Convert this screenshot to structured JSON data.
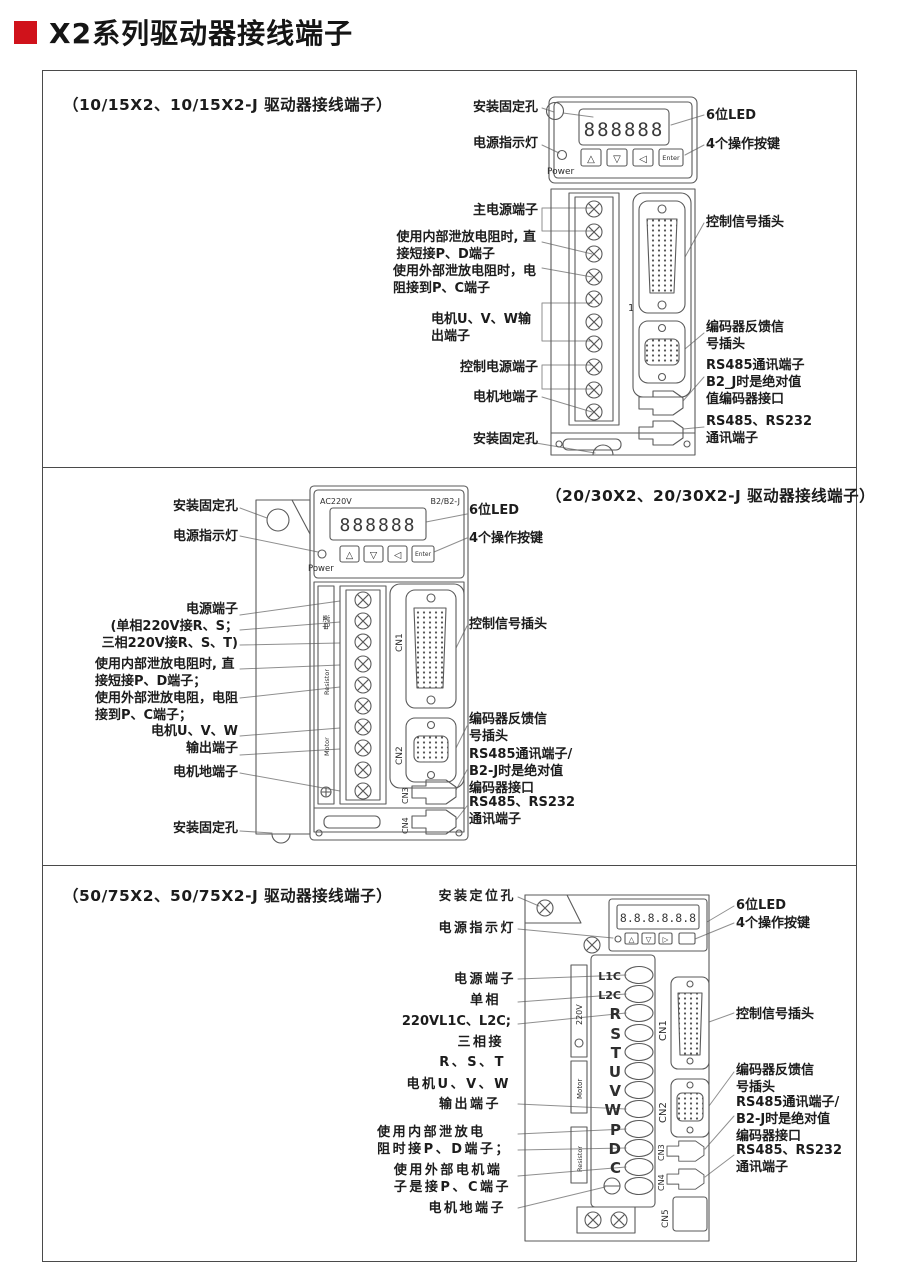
{
  "page_title": "X2系列驱动器接线端子",
  "colors": {
    "accent": "#d0121b",
    "line": "#5a5a5a",
    "text": "#1c1c1c"
  },
  "panels": [
    {
      "title": "（10/15X2、10/15X2-J 驱动器接线端子）",
      "left_labels": [
        {
          "text": "安装固定孔"
        },
        {
          "text": "电源指示灯"
        },
        {
          "text": "主电源端子"
        },
        {
          "text": "使用内部泄放电阻时, 直\n接短接P、D端子"
        },
        {
          "text": "使用外部泄放电阻时，电\n阻接到P、C端子"
        },
        {
          "text": "电机U、V、W输\n出端子"
        },
        {
          "text": "控制电源端子"
        },
        {
          "text": "电机地端子"
        },
        {
          "text": "安装固定孔"
        }
      ],
      "right_labels": [
        {
          "text": "6位LED"
        },
        {
          "text": "4个操作按键"
        },
        {
          "text": "控制信号插头"
        },
        {
          "text": "编码器反馈信\n号插头"
        },
        {
          "text": "RS485通讯端子\nB2_J时是绝对值\n值编码器接口"
        },
        {
          "text": "RS485、RS232\n通讯端子"
        }
      ],
      "device": {
        "display": "888888",
        "power": "Power",
        "buttons": [
          "△",
          "▽",
          "◁",
          "Enter"
        ],
        "body_number": "1"
      }
    },
    {
      "title": "（20/30X2、20/30X2-J 驱动器接线端子）",
      "left_labels": [
        {
          "text": "安装固定孔"
        },
        {
          "text": "电源指示灯"
        },
        {
          "text": "电源端子\n(单相220V接R、S；\n三相220V接R、S、T)"
        },
        {
          "text": "使用内部泄放电阻时, 直\n接短接P、D端子；\n使用外部泄放电阻，电阻\n接到P、C端子；"
        },
        {
          "text": "电机U、V、W\n输出端子"
        },
        {
          "text": "电机地端子"
        },
        {
          "text": "安装固定孔"
        }
      ],
      "right_labels": [
        {
          "text": "6位LED"
        },
        {
          "text": "4个操作按键"
        },
        {
          "text": "控制信号插头"
        },
        {
          "text": "编码器反馈信\n号插头"
        },
        {
          "text": "RS485通讯端子/\nB2-J时是绝对值\n编码器接口"
        },
        {
          "text": "RS485、RS232\n通讯端子"
        }
      ],
      "device": {
        "top_left": "AC220V",
        "top_right": "B2/B2-J",
        "display": "888888",
        "power": "Power",
        "buttons": [
          "△",
          "▽",
          "◁",
          "Enter"
        ],
        "strip_labels": [
          "电源",
          "Resistor",
          "Motor"
        ],
        "connectors": [
          "CN1",
          "CN2",
          "CN3",
          "CN4"
        ]
      }
    },
    {
      "title": "（50/75X2、50/75X2-J 驱动器接线端子）",
      "left_labels": [
        {
          "text": "安装定位孔"
        },
        {
          "text": "电源指示灯"
        },
        {
          "text": "电源端子"
        },
        {
          "text": "单相"
        },
        {
          "text": "220VL1C、L2C;"
        },
        {
          "text": "三相接"
        },
        {
          "text": "R、S、T"
        },
        {
          "text": "电机U、V、W"
        },
        {
          "text": "输出端子"
        },
        {
          "text": "使用内部泄放电\n阻时接P、D端子；"
        },
        {
          "text": "使用外部电机端\n子是接P、C端子"
        },
        {
          "text": "电机地端子"
        }
      ],
      "right_labels": [
        {
          "text": "6位LED"
        },
        {
          "text": "4个操作按键"
        },
        {
          "text": "控制信号插头"
        },
        {
          "text": "编码器反馈信\n号插头"
        },
        {
          "text": "RS485通讯端子/\nB2-J时是绝对值\n编码器接口"
        },
        {
          "text": "RS485、RS232\n通讯端子"
        }
      ],
      "device": {
        "display": "8.8.8.8.8.8",
        "buttons": [
          "△",
          "▽",
          "▷"
        ],
        "side_volt": "220V",
        "side_motor": "Motor",
        "side_resistor": "Resistor",
        "terminals": [
          "L1C",
          "L2C",
          "R",
          "S",
          "T",
          "U",
          "V",
          "W",
          "P",
          "D",
          "C"
        ],
        "connectors": [
          "CN1",
          "CN2",
          "CN3",
          "CN4",
          "CN5"
        ]
      }
    }
  ]
}
